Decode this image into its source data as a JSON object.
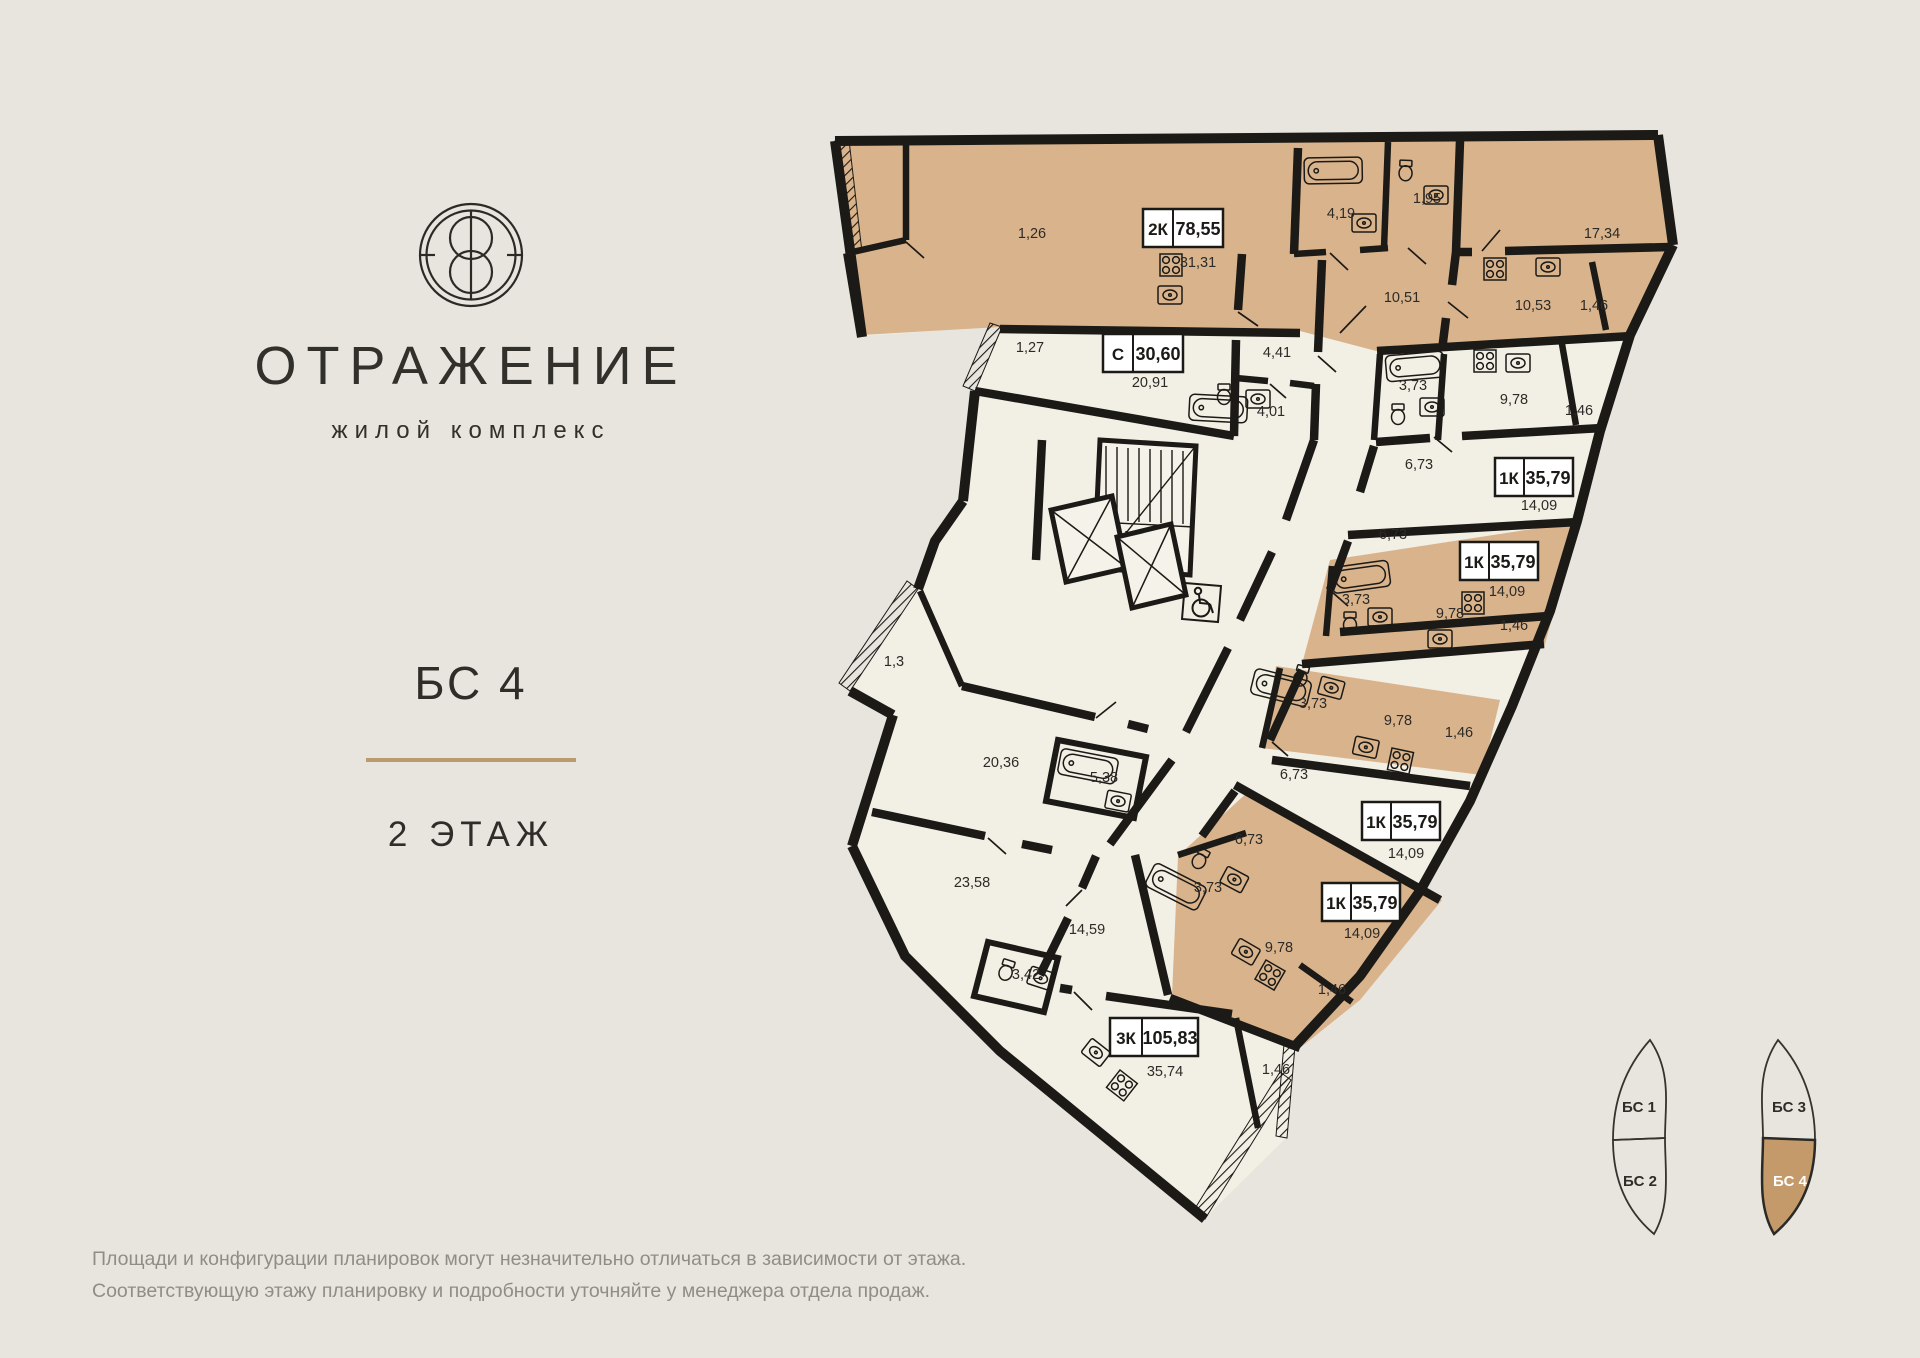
{
  "brand": {
    "name": "ОТРАЖЕНИЕ",
    "tagline": "жилой комплекс",
    "logo_icon": "reflection-emblem"
  },
  "section": {
    "title": "БС 4",
    "floor": "2 ЭТАЖ"
  },
  "plan": {
    "tags": [
      {
        "type": "2К",
        "area": "78,55"
      },
      {
        "type": "С",
        "area": "30,60"
      },
      {
        "type": "1К",
        "area": "35,79"
      },
      {
        "type": "1К",
        "area": "35,79"
      },
      {
        "type": "1К",
        "area": "35,79"
      },
      {
        "type": "1К",
        "area": "35,79"
      },
      {
        "type": "3К",
        "area": "105,83"
      }
    ],
    "labels": [
      "1,26",
      "31,31",
      "4,19",
      "1,95",
      "17,34",
      "10,51",
      "10,53",
      "1,46",
      "1,27",
      "20,91",
      "4,41",
      "4,01",
      "3,73",
      "9,78",
      "1,46",
      "6,73",
      "14,09",
      "6,73",
      "14,09",
      "3,73",
      "9,78",
      "1,46",
      "3,73",
      "9,78",
      "1,46",
      "6,73",
      "14,09",
      "6,73",
      "3,73",
      "14,09",
      "9,78",
      "1,46",
      "1,3",
      "20,36",
      "5,38",
      "23,58",
      "14,59",
      "3,42",
      "35,74",
      "1,46"
    ]
  },
  "minimap": {
    "sections": [
      {
        "label": "БС 1",
        "active": false
      },
      {
        "label": "БС 2",
        "active": false
      },
      {
        "label": "БС 3",
        "active": false
      },
      {
        "label": "БС 4",
        "active": true
      }
    ]
  },
  "footer": {
    "line1": "Площади и конфигурации планировок могут незначительно отличаться в зависимости от этажа.",
    "line2": "Соответствующую этажу планировку и подробности уточняйте у менеджера отдела продаж."
  },
  "colors": {
    "background": "#e8e5de",
    "wall": "#1b1a16",
    "room_cream": "#f2efe5",
    "room_tan": "#d9b38c",
    "accent_divider": "#bb9a72",
    "minimap_active": "#c49a6a",
    "text_muted": "#908d85"
  }
}
